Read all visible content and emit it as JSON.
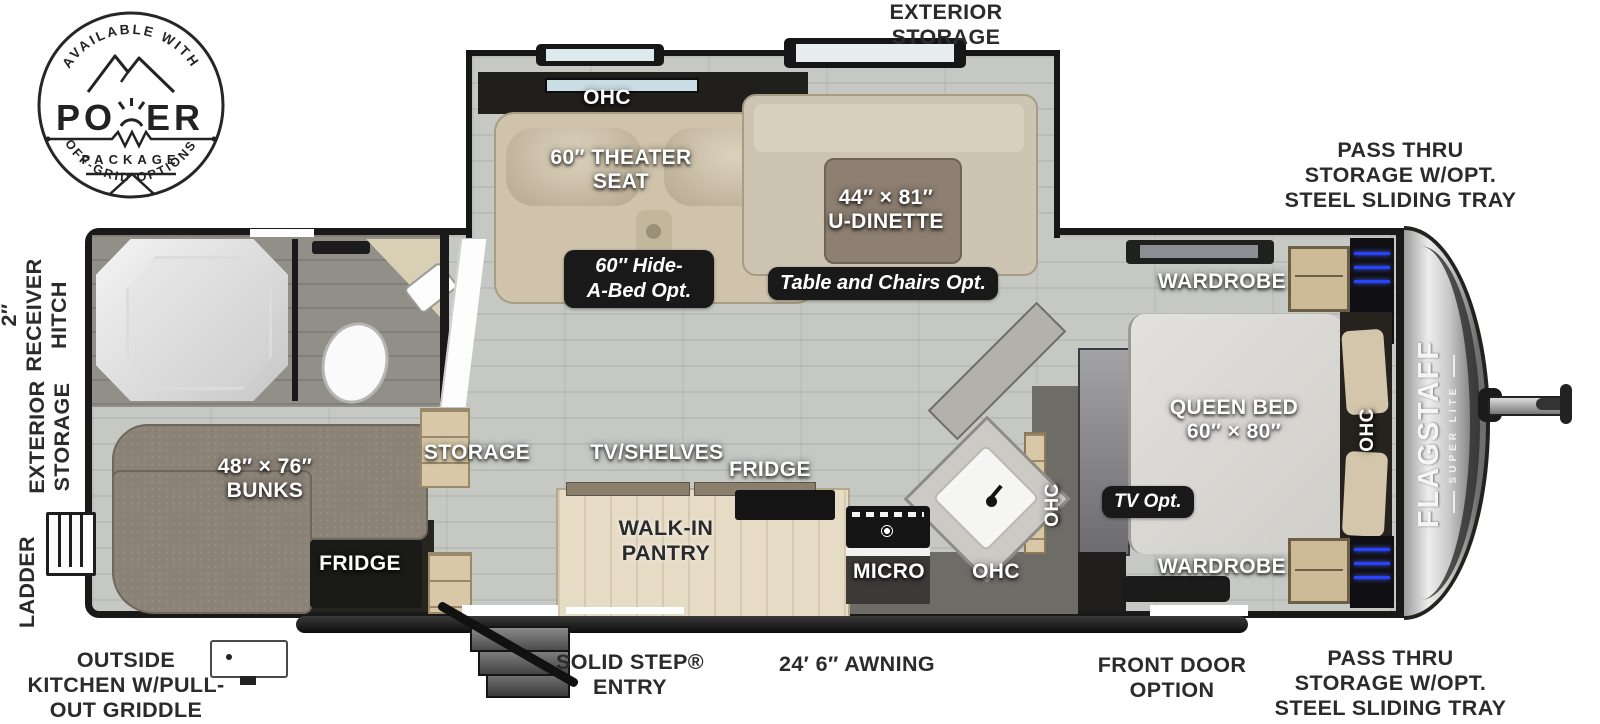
{
  "power_badge": {
    "arc_top": "AVAILABLE WITH",
    "word_left": "PO",
    "word_right": "ER",
    "subtitle": "PACKAGE",
    "arc_bottom": "OFF-GRID OPTIONS"
  },
  "brand": {
    "name": "FLAGSTAFF",
    "sub": "SUPER LITE"
  },
  "exterior": {
    "storage_top": [
      "EXTERIOR",
      "STORAGE"
    ],
    "pass_thru_top": [
      "PASS THRU",
      "STORAGE W/OPT.",
      "STEEL SLIDING TRAY"
    ],
    "pass_thru_bottom": [
      "PASS THRU",
      "STORAGE W/OPT.",
      "STEEL SLIDING TRAY"
    ],
    "receiver_hitch": [
      "2″",
      "RECEIVER",
      "HITCH"
    ],
    "storage_left": [
      "EXTERIOR",
      "STORAGE"
    ],
    "ladder": "LADDER",
    "outside_kitchen": [
      "OUTSIDE",
      "KITCHEN W/PULL-",
      "OUT GRIDDLE"
    ],
    "entry": [
      "SOLID STEP®",
      "ENTRY"
    ],
    "awning": "24′ 6″ AWNING",
    "front_door": [
      "FRONT DOOR",
      "OPTION"
    ]
  },
  "interior": {
    "slide_ohc": "OHC",
    "theater_seat": [
      "60″ THEATER",
      "SEAT"
    ],
    "u_dinette": [
      "44″ × 81″",
      "U-DINETTE"
    ],
    "bunks": [
      "48″ × 76″",
      "BUNKS"
    ],
    "bunk_fridge": "FRIDGE",
    "storage": "STORAGE",
    "tv_shelves": "TV/SHELVES",
    "fridge": "FRIDGE",
    "pantry": [
      "WALK-IN",
      "PANTRY"
    ],
    "micro": "MICRO",
    "ohc_kitchen": "OHC",
    "ohc_kitchen_side": "OHC",
    "wardrobe_top": "WARDROBE",
    "queen_bed": [
      "QUEEN BED",
      "60″ × 80″"
    ],
    "ohc_bed": "OHC",
    "wardrobe_bottom": "WARDROBE"
  },
  "options": {
    "hide_a_bed": [
      "60″ Hide-",
      "A-Bed Opt."
    ],
    "table_chairs": "Table and Chairs Opt.",
    "tv": "TV Opt."
  },
  "colors": {
    "wall": "#191919",
    "floor": "#c6c8c3",
    "accent_neon": "#2743ff",
    "badge_bg": "#191919"
  }
}
